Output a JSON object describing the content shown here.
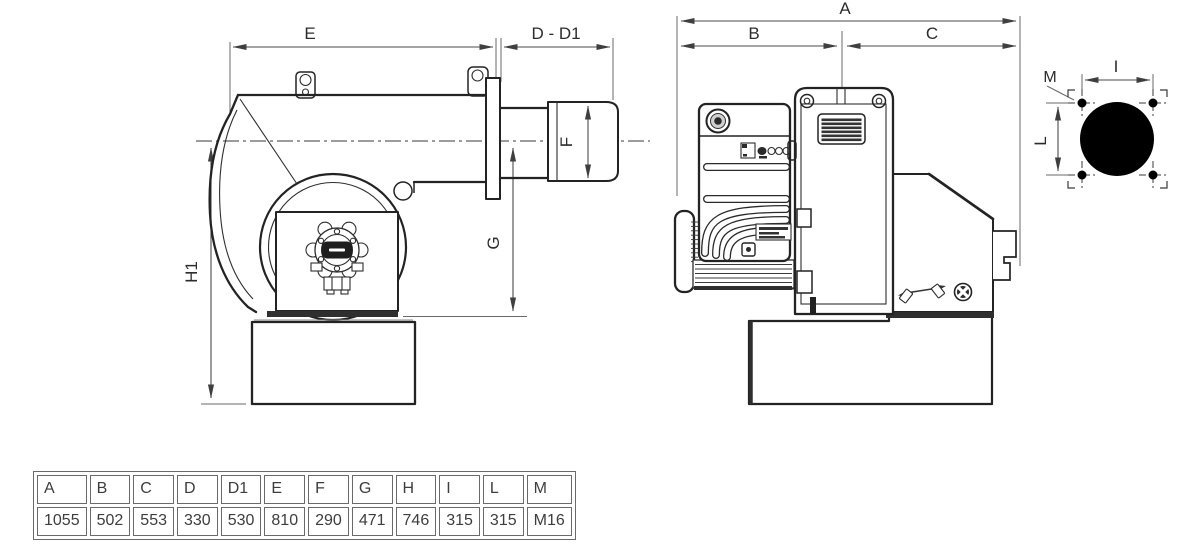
{
  "colors": {
    "ink": "#2a2a2a",
    "dim_line": "#4a4a4a",
    "table_border": "#6a6a6a",
    "table_text": "#3d3d3d"
  },
  "side_view": {
    "labels": {
      "e": "E",
      "d_d1": "D - D1",
      "f": "F",
      "g": "G",
      "h1": "H1"
    }
  },
  "rear_view": {
    "labels": {
      "a": "A",
      "b": "B",
      "c": "C"
    }
  },
  "flange_view": {
    "labels": {
      "m": "M",
      "i": "I",
      "l": "L"
    }
  },
  "table": {
    "headers": [
      "A",
      "B",
      "C",
      "D",
      "D1",
      "E",
      "F",
      "G",
      "H",
      "I",
      "L",
      "M"
    ],
    "values": [
      "1055",
      "502",
      "553",
      "330",
      "530",
      "810",
      "290",
      "471",
      "746",
      "315",
      "315",
      "M16"
    ]
  }
}
